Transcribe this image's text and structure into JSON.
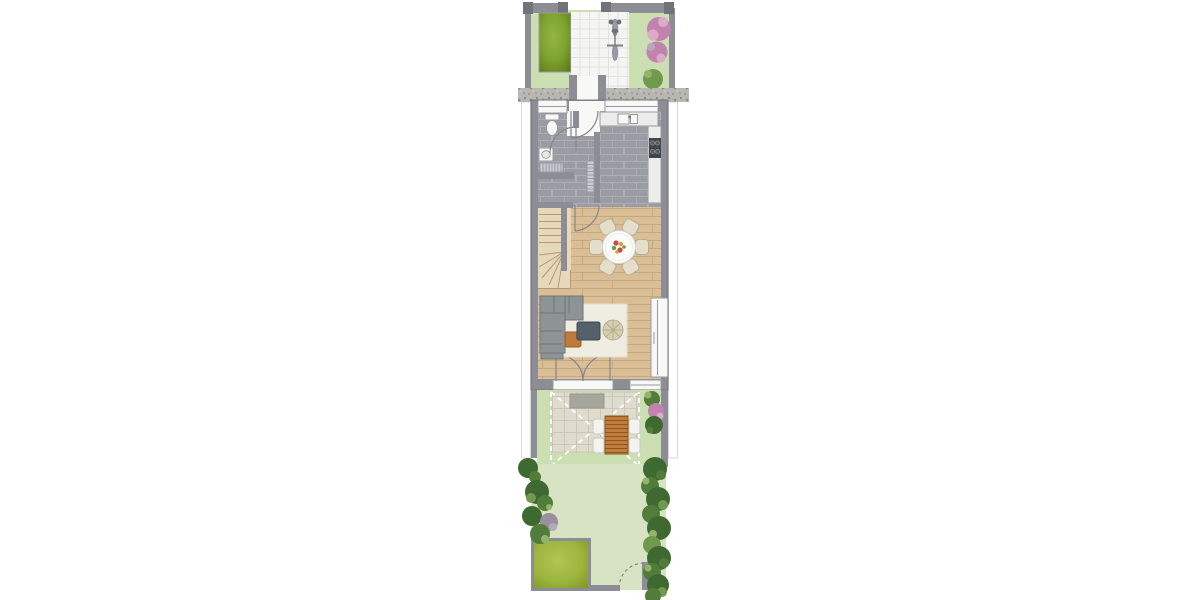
{
  "plan": {
    "type": "residential-ground-floor-plan",
    "front_garden": {
      "features": [
        "street-wall-with-piers",
        "planting-bed",
        "tiled-entry-path",
        "bicycle",
        "pink-flowering-shrubs",
        "green-shrub",
        "gravel-strip",
        "entrance-porch"
      ]
    },
    "building": {
      "rooms": [
        {
          "name": "wc",
          "fixtures": [
            "window",
            "toilet",
            "washbasin",
            "radiator",
            "door"
          ]
        },
        {
          "name": "hallway",
          "fixtures": [
            "front-door",
            "radiator",
            "door-to-living"
          ]
        },
        {
          "name": "kitchen",
          "fixtures": [
            "window",
            "worktop",
            "sink",
            "cooktop"
          ]
        },
        {
          "name": "staircase",
          "fixtures": [
            "winder-stairs"
          ]
        },
        {
          "name": "dining-area",
          "furniture": [
            "round-table",
            "flower-centerpiece",
            "chairs"
          ],
          "chair_count": 6
        },
        {
          "name": "living-area",
          "furniture": [
            "corner-sofa",
            "rug",
            "coffee-table",
            "wooden-side-table",
            "pouf",
            "full-height-window",
            "french-doors"
          ]
        }
      ]
    },
    "terrace": {
      "features": [
        "paved-patio",
        "doormat",
        "dashed-awning-outline",
        "wooden-picnic-table",
        "garden-seats",
        "shrubs"
      ],
      "seat_count": 4
    },
    "back_garden": {
      "features": [
        "lawn",
        "tree-row-left",
        "tree-row-right",
        "purple-shrub",
        "green-lawn-square",
        "boundary-wall",
        "garden-gate-with-swing"
      ]
    },
    "adjacent_units": [
      "left-neighbor-outline",
      "right-neighbor-outline"
    ]
  },
  "colors": {
    "page_bg": "#ffffff",
    "grass": "#ccdfb2",
    "grass_light": "#d7e3c2",
    "wall": "#8d8d95",
    "wall_dark": "#72727a",
    "outline": "#9a9aa2",
    "gravel": "#b9b7b2",
    "path": "#f5f5f3",
    "path_line": "#e1e1df",
    "tile": "#9b9ba3",
    "tile_line": "#aeaeb6",
    "wood": "#d9be96",
    "wood_line": "#c7a87e",
    "stair": "#e7d8bc",
    "stair_line": "#b19a75",
    "fixture_white": "#f8f8f6",
    "counter": "#ececea",
    "cooktop": "#40454c",
    "burner": "#565c64",
    "radiator": "#ccccd4",
    "sofa": "#8e9394",
    "sofa_line": "#70767a",
    "rug": "#efece2",
    "coffee_table": "#566069",
    "side_table": "#bd7a38",
    "pouf": "#d7d0ae",
    "chair": "#e5deca",
    "chair_line": "#b6ae93",
    "table_top": "#fbfbf9",
    "flower_red": "#cb4a3c",
    "flower_orange": "#dd9b3d",
    "flower_green": "#6f9a44",
    "terrace_tile": "#dfdbcd",
    "terrace_line": "#cbc7b9",
    "mat": "#a6a69c",
    "picnic_wood": "#c17d3e",
    "picnic_dark": "#91561d",
    "seat": "#f3f3f1",
    "seat_line": "#c9c9c1",
    "planter": "#7da22f",
    "planter_hi": "#93b545",
    "planter_dark": "#5e7b1a",
    "lawn": "#9db63e",
    "lawn_hi": "#b1c656",
    "lawn_dark": "#7f9827",
    "tree_dark": "#3e6a31",
    "tree_mid": "#527c3a",
    "tree_light": "#6f9a4e",
    "tree_hi": "#93b46a",
    "pink": "#c183ad",
    "pink_hi": "#dcabc9",
    "purple": "#998fa0",
    "purple_hi": "#b4aabc",
    "door_arc": "#85858d",
    "dash": "#ffffff",
    "neighbor_line": "#d8d8d8"
  }
}
